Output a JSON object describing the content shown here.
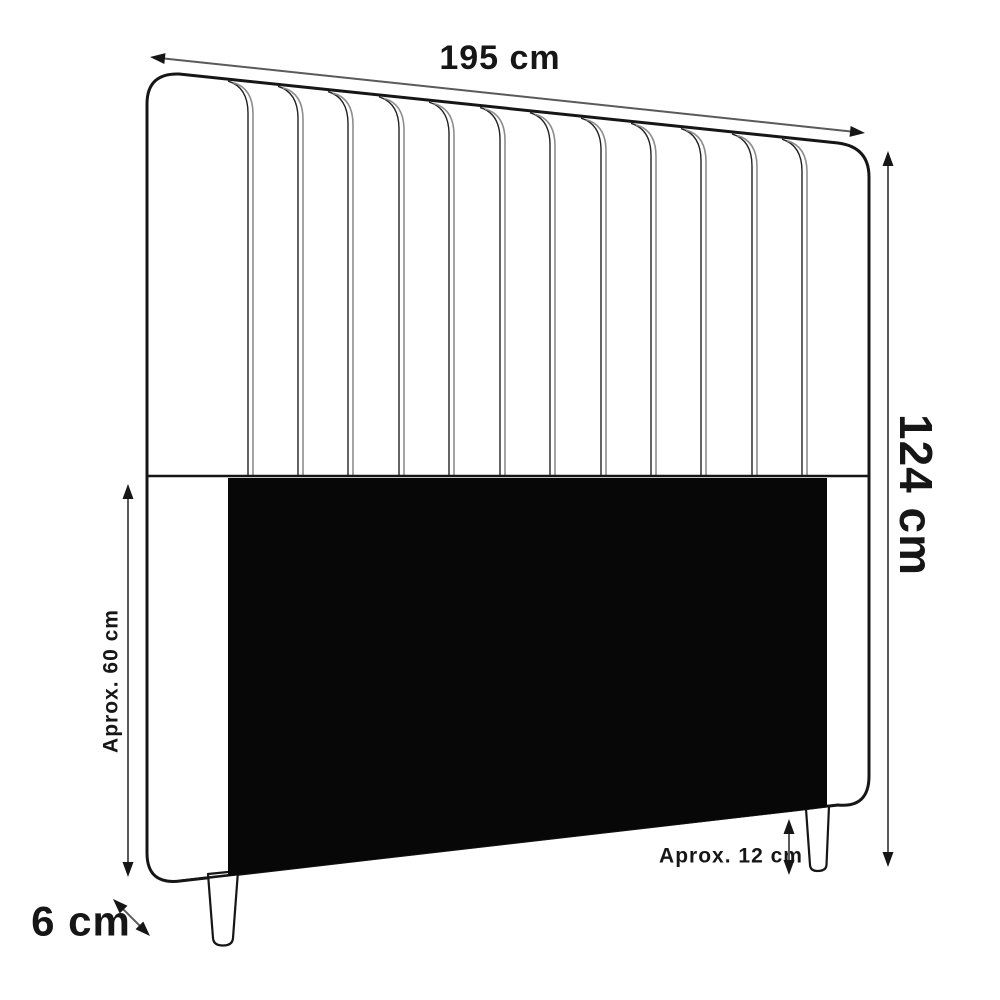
{
  "diagram": {
    "name": "headboard-dimension-diagram",
    "labels": {
      "width": "195 cm",
      "height": "124 cm",
      "lower_panel_height": "Aprox. 60 cm",
      "leg_height": "Aprox. 12 cm",
      "leg_width": "6 cm"
    },
    "structure": {
      "channel_seam_count": 12,
      "leg_count": 2,
      "lower_panel_color": "dark",
      "style": "vertical channel tufted headboard, slight perspective"
    },
    "colors": {
      "background": "#ffffff",
      "outline": "#161616",
      "seam_gray": "#8d8d8d",
      "dimension_line": "#5a5a5a",
      "arrowhead": "#161616",
      "panel_fill": "#070707",
      "body_fill": "#ffffff"
    }
  }
}
